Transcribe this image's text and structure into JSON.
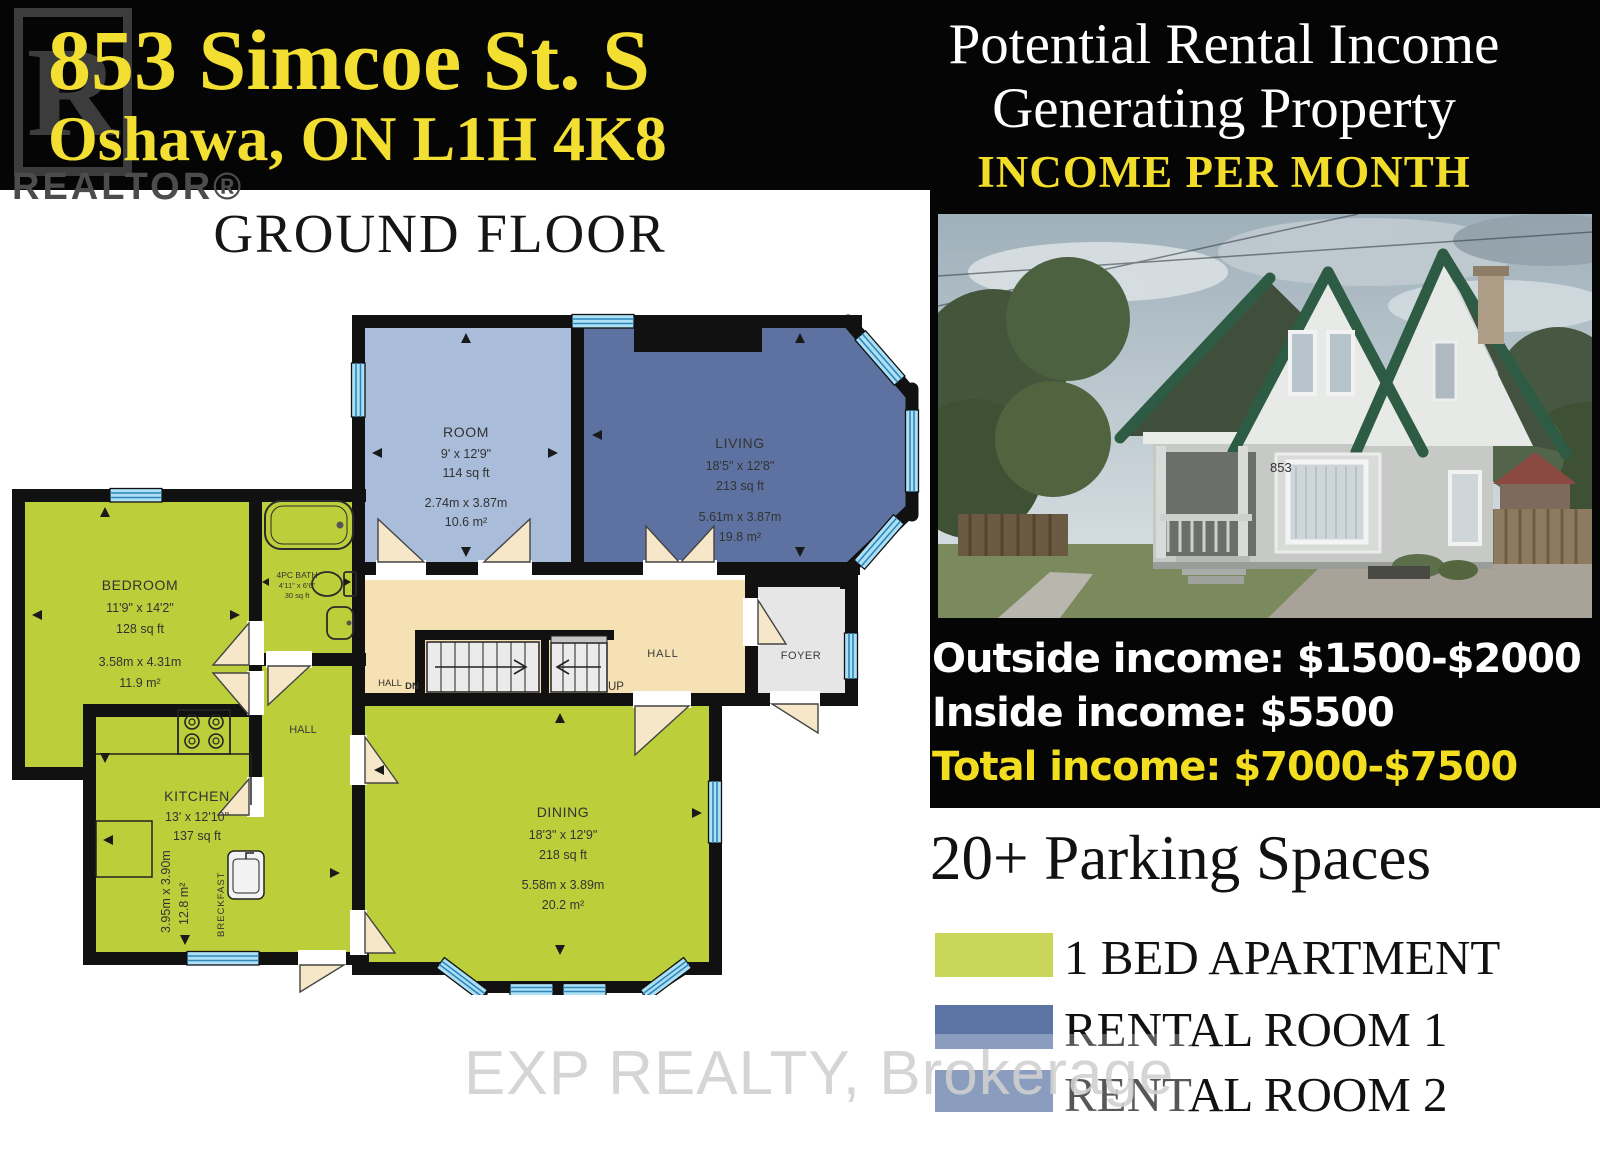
{
  "header": {
    "address_line1": "853 Simcoe St. S",
    "address_line2": "Oshawa, ON L1H 4K8",
    "realtor_r": "R",
    "realtor_label": "REALTOR®"
  },
  "panel": {
    "title_line1": "Potential Rental Income",
    "title_line2": "Generating Property",
    "subtitle": "INCOME PER MONTH",
    "outside_income": "Outside income: $1500-$2000",
    "inside_income": "Inside income: $5500",
    "total_income": "Total income: $7000-$7500"
  },
  "photo": {
    "house_number": "853"
  },
  "parking_title": "20+ Parking Spaces",
  "legend": {
    "items": [
      {
        "label": "1 BED APARTMENT",
        "color": "#c9d558"
      },
      {
        "label": "RENTAL ROOM 1",
        "color": "#5b74a3"
      },
      {
        "label": "RENTAL ROOM 2",
        "color": "#5b74a3"
      }
    ]
  },
  "watermark": "EXP REALTY, Brokerage",
  "colors": {
    "apartment_green": "#bccf3a",
    "room_blue": "#a9bcd9",
    "living_blue": "#5d72a0",
    "hall_tan": "#f5e1b3",
    "foyer_gray": "#e6e6e6",
    "accent_yellow": "#f2de1f"
  },
  "floorplan": {
    "title": "GROUND FLOOR",
    "rooms": {
      "room": {
        "name": "ROOM",
        "dims_ft": "9' x 12'9\"",
        "area_ft": "114 sq ft",
        "dims_m": "2.74m x 3.87m",
        "area_m": "10.6 m²"
      },
      "living": {
        "name": "LIVING",
        "dims_ft": "18'5\" x 12'8\"",
        "area_ft": "213 sq ft",
        "dims_m": "5.61m x 3.87m",
        "area_m": "19.8 m²"
      },
      "bedroom": {
        "name": "BEDROOM",
        "dims_ft": "11'9\" x 14'2\"",
        "area_ft": "128 sq ft",
        "dims_m": "3.58m x 4.31m",
        "area_m": "11.9 m²"
      },
      "bath": {
        "name": "4PC BATH",
        "dims_ft": "4'11\" x 6'6\"",
        "area_ft": "30 sq ft"
      },
      "kitchen": {
        "name": "KITCHEN",
        "dims_ft": "13' x 12'10\"",
        "area_ft": "137 sq ft",
        "dims_m": "3.95m x 3.90m",
        "area_m": "12.8 m²",
        "breakfast": "BRECKFAST"
      },
      "dining": {
        "name": "DINING",
        "dims_ft": "18'3\" x 12'9\"",
        "area_ft": "218 sq ft",
        "dims_m": "5.58m x 3.89m",
        "area_m": "20.2 m²"
      }
    },
    "labels": {
      "hall_main": "HALL",
      "hall_small": "HALL",
      "hall_stair": "HALL",
      "dn": "DN",
      "up": "UP",
      "foyer": "FOYER"
    }
  }
}
